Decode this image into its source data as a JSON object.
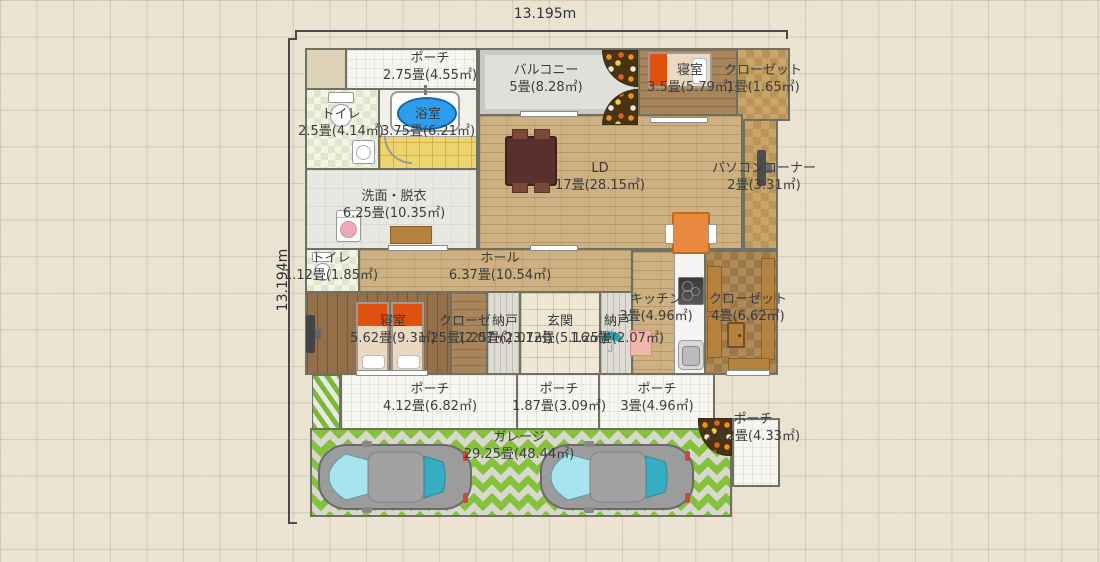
{
  "dimensions": {
    "width_label": "13.195m",
    "height_label": "13.194m"
  },
  "rooms": {
    "porch_top": {
      "name": "ポーチ",
      "size": "2.75畳(4.55㎡)"
    },
    "toilet_upper": {
      "name": "トイレ",
      "size": "2.5畳(4.14㎡)"
    },
    "bathroom": {
      "name": "浴室",
      "size": "3.75畳(6.21㎡)"
    },
    "washroom": {
      "name": "洗面・脱衣",
      "size": "6.25畳(10.35㎡)"
    },
    "balcony": {
      "name": "バルコニー",
      "size": "5畳(8.28㎡)"
    },
    "bedroom_upper": {
      "name": "寝室",
      "size": "3.5畳(5.79㎡)"
    },
    "closet_upper": {
      "name": "クローゼット",
      "size": "1畳(1.65㎡)"
    },
    "ld": {
      "name": "LD",
      "size": "17畳(28.15㎡)"
    },
    "pc_corner": {
      "name": "パソコンコーナー",
      "size": "2畳(3.31㎡)"
    },
    "toilet_mid": {
      "name": "トイレ",
      "size": "1.12畳(1.85㎡)"
    },
    "hall": {
      "name": "ホール",
      "size": "6.37畳(10.54㎡)"
    },
    "bedroom_lower": {
      "name": "寝室",
      "size": "5.62畳(9.3㎡)"
    },
    "closet_small": {
      "name": "クローゼ",
      "size": "1.25畳(2.07㎡)"
    },
    "storage_a": {
      "name": "納戸",
      "size": "1.25畳(2.07㎡)"
    },
    "entrance": {
      "name": "玄関",
      "size": "3.12畳(5.16㎡)"
    },
    "storage_b": {
      "name": "納戸",
      "size": "1.25畳(2.07㎡)"
    },
    "kitchen": {
      "name": "キッチン",
      "size": "3畳(4.96㎡)"
    },
    "closet_large": {
      "name": "クローゼット",
      "size": "4畳(6.62㎡)"
    },
    "porch_w": {
      "name": "ポーチ",
      "size": "4.12畳(6.82㎡)"
    },
    "porch_c": {
      "name": "ポーチ",
      "size": "1.87畳(3.09㎡)"
    },
    "porch_e": {
      "name": "ポーチ",
      "size": "3畳(4.96㎡)"
    },
    "porch_se": {
      "name": "ポーチ",
      "size": "2.62畳(4.33㎡)"
    },
    "garage": {
      "name": "ガレージ",
      "size": "29.25畳(48.44㎡)"
    }
  },
  "icons": {
    "umbrella": "☂"
  },
  "colors": {
    "wall": "#6d7262",
    "wood_light": "#cdb183",
    "wood_mid": "#a9855c",
    "wood_dark": "#936f4a",
    "tile_yellow": "#eed46f",
    "garage_green": "#85c23c",
    "tub_blue": "#2e9df0",
    "furniture_orange": "#e8893f",
    "bed_orange": "#e0500e"
  }
}
